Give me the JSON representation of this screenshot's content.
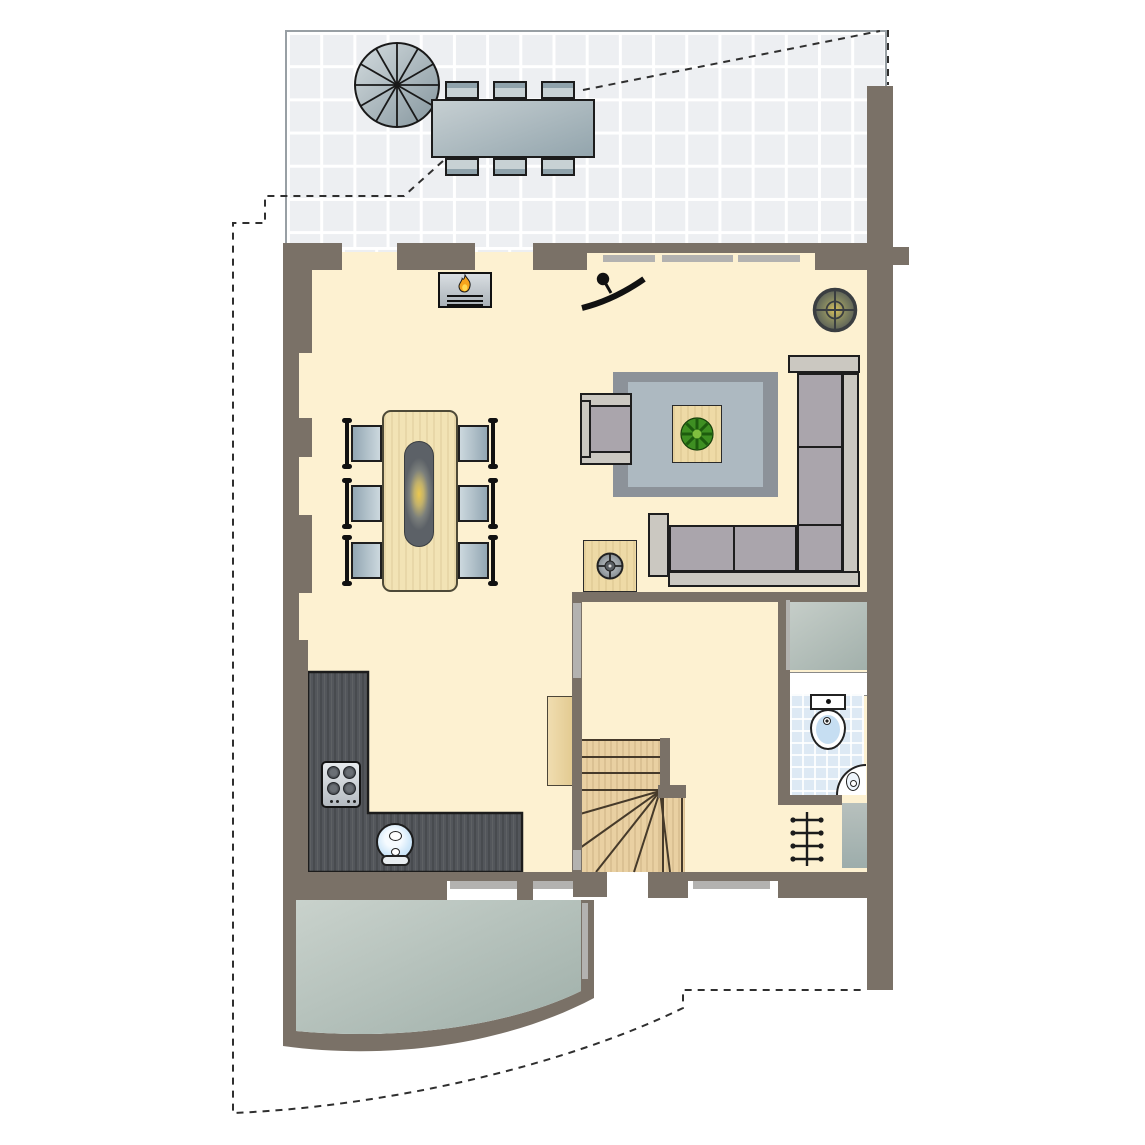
{
  "document": {
    "kind": "architectural-floor-plan",
    "view": "top-down",
    "visible_text": "none"
  },
  "palette": {
    "wall": "#7a7167",
    "floor_cream": "#fdf1d1",
    "terrace_tile": "#edeff2",
    "tile_grout": "#ffffff",
    "garden_room_fill": "#b9c4be",
    "window_frame": "#b3b2b0",
    "kitchen_counter": "#53565b",
    "wood_light": "#f2e3b5",
    "stair_wood": "#e9d0a2",
    "sofa_cushion": "#aaa5ac",
    "sofa_frame": "#cbc8c1",
    "rug_outer": "#8c9299",
    "rug_inner": "#adb9c1",
    "chair_seat": "#a9bcc7",
    "bath_tile": "#dde9f4",
    "plant_green": "#3e8f22",
    "flame_orange": "#f5a41c",
    "lamp_glow": "#ecc84f",
    "boundary_dash": "#2f2f2f"
  },
  "rooms": {
    "terrace": {
      "floor": "tiles",
      "items": [
        "spiral-staircase",
        "outdoor-dining-table"
      ],
      "outdoor_chairs": 6
    },
    "living_room": {
      "items": [
        "fireplace",
        "wall-tv",
        "ceiling-lamp",
        "rug",
        "coffee-table",
        "potted-plant",
        "corner-sofa",
        "armchair",
        "side-table",
        "tall-cabinet"
      ]
    },
    "dining_area": {
      "dining_table": 1,
      "dining_chairs": 6,
      "pendant_lamp": 1
    },
    "kitchen": {
      "counter": "L-shaped",
      "hob_burners": 4,
      "sink": 1
    },
    "hall": {
      "staircase": "winder",
      "straight_treads": 3,
      "winder_treads": 5,
      "front_door_opening": 1
    },
    "bathroom": {
      "toilet": 1,
      "corner_sink": 1,
      "floor": "tiled"
    },
    "closet": {
      "count": 1
    },
    "radiator": {
      "sections": 4
    },
    "garden_room": {
      "shape": "curved-bottom"
    },
    "property_boundary": {
      "style": "dashed-line"
    }
  }
}
